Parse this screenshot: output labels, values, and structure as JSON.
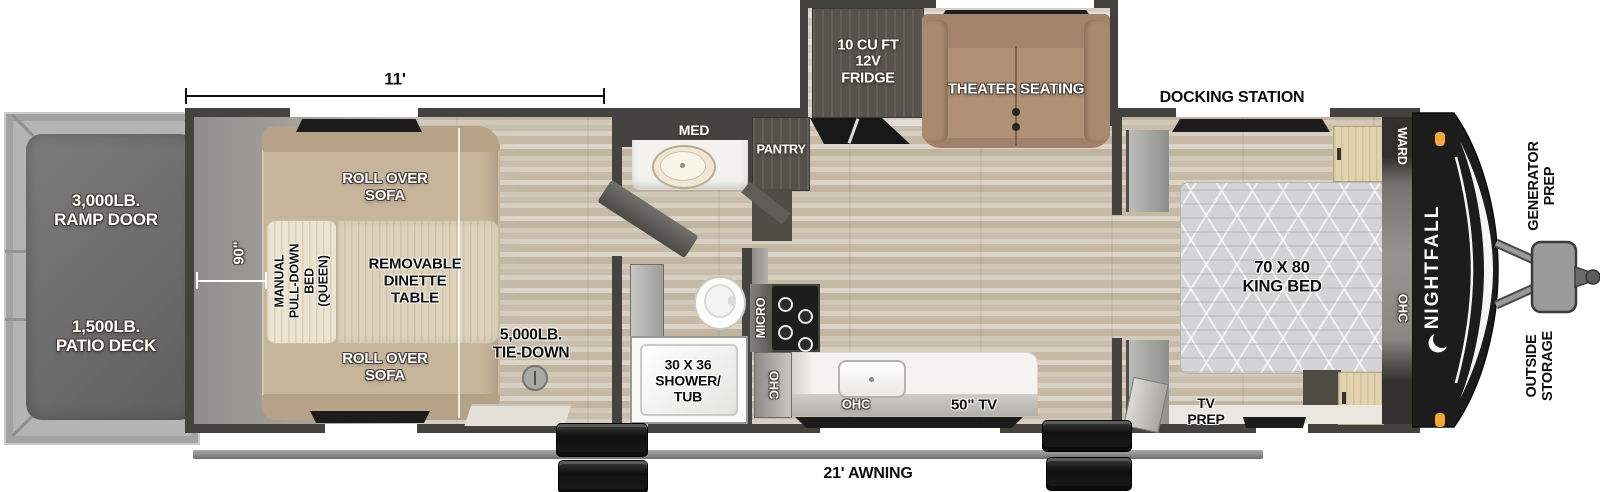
{
  "brand": {
    "name": "NIGHTFALL",
    "moon_icon": "crescent-moon"
  },
  "dimensions": {
    "garage_length": "11'",
    "garage_width": "90\"",
    "awning": "21' AWNING"
  },
  "rear_exterior": {
    "ramp_door": "3,000LB.\nRAMP DOOR",
    "patio_deck": "1,500LB.\nPATIO DECK"
  },
  "garage": {
    "sofa_top": "ROLL OVER\nSOFA",
    "sofa_bottom": "ROLL OVER\nSOFA",
    "pull_down_bed": "MANUAL\nPULL-DOWN\nBED\n(QUEEN)",
    "dinette_table": "REMOVABLE\nDINETTE\nTABLE",
    "tie_down": "5,000LB.\nTIE-DOWN"
  },
  "bathroom": {
    "medicine_cabinet": "MED",
    "shower_tub": "30 X 36\nSHOWER/\nTUB"
  },
  "kitchen": {
    "pantry": "PANTRY",
    "fridge": "10 CU FT\n12V\nFRIDGE",
    "microwave": "MICRO",
    "ohc_side": "OHC",
    "ohc_counter": "OHC",
    "tv": "50\" TV"
  },
  "living_room": {
    "theater_seating": "THEATER SEATING"
  },
  "bedroom": {
    "docking_station": "DOCKING STATION",
    "king_bed": "70 X 80\nKING BED",
    "wardrobe": "WARD",
    "ohc": "OHC",
    "tv_prep": "TV\nPREP"
  },
  "front_exterior": {
    "generator_prep": "GENERATOR\nPREP",
    "outside_storage": "OUTSIDE\nSTORAGE"
  },
  "colors": {
    "wall": "#45433f",
    "wood_floor": "#cfc5b4",
    "sofa_tan": "#c6b49b",
    "theater_tan": "#b19175",
    "cabinet_dark": "#57524b",
    "front_cap": "#1c1c1c",
    "marker_light": "#f5a63a",
    "deck_gray": "#6b6b6b"
  }
}
